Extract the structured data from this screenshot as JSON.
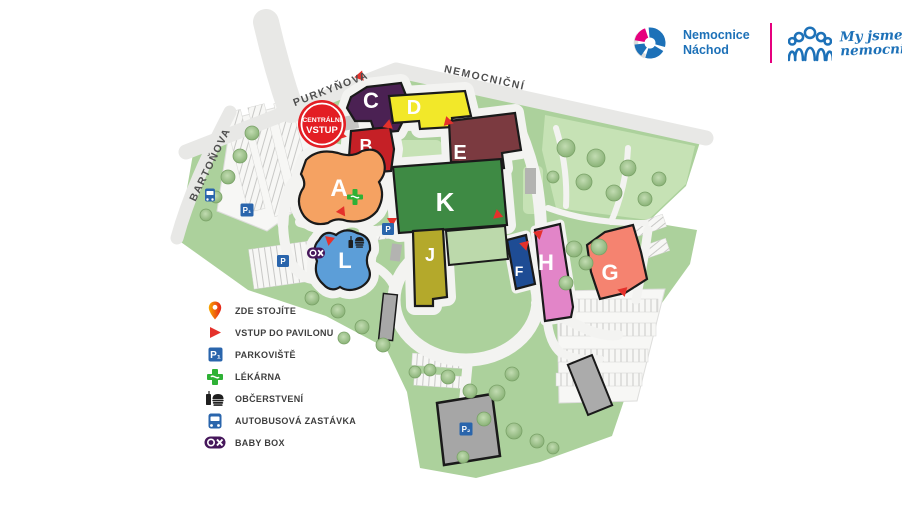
{
  "brand": {
    "hospital_name": [
      "Nemocnice",
      "Náchod"
    ],
    "slogan": [
      "My jsme",
      "nemocnice"
    ]
  },
  "streets": {
    "purkynova": "PURKYŇOVA",
    "nemocnicni": "NEMOCNIČNÍ",
    "bartonova": "BARTOŇOVA"
  },
  "central_entrance": {
    "line1": "CENTRÁLNÍ",
    "line2": "VSTUP"
  },
  "buildings": [
    {
      "label": "A",
      "color": "#F5A262"
    },
    {
      "label": "B",
      "color": "#C52026"
    },
    {
      "label": "C",
      "color": "#4B2153"
    },
    {
      "label": "D",
      "color": "#F2E829"
    },
    {
      "label": "E",
      "color": "#7B3A40"
    },
    {
      "label": "F",
      "color": "#1E4C94"
    },
    {
      "label": "G",
      "color": "#F58370"
    },
    {
      "label": "H",
      "color": "#E285C8"
    },
    {
      "label": "J",
      "color": "#B4A92B"
    },
    {
      "label": "K",
      "color": "#3E8A44"
    },
    {
      "label": "L",
      "color": "#5C9ED8"
    }
  ],
  "parking": {
    "p": "P",
    "p1": "P₁",
    "p2": "P₂"
  },
  "legend": {
    "items": [
      {
        "icon": "you-are-here-pin",
        "label": "ZDE STOJÍTE"
      },
      {
        "icon": "pavilion-entrance-triangle",
        "label": "VSTUP DO PAVILONU"
      },
      {
        "icon": "parking-sign",
        "label": "PARKOVIŠTĚ"
      },
      {
        "icon": "pharmacy-cross",
        "label": "LÉKÁRNA"
      },
      {
        "icon": "refreshment",
        "label": "OBČERSTVENÍ"
      },
      {
        "icon": "bus-stop",
        "label": "AUTOBUSOVÁ ZASTÁVKA"
      },
      {
        "icon": "baby-box",
        "label": "BABY BOX"
      }
    ]
  },
  "accents": {
    "entrance-red": "#E5312B",
    "badge-red": "#E31E24",
    "parking-blue": "#2A65AC",
    "pharmacy-green": "#2EB135",
    "babybox-purple": "#46175B",
    "brand-blue": "#1D71B8",
    "brand-pink": "#E6007E",
    "building-outline": "#1A1A1A",
    "map-green": "#ACD19C",
    "map-green-light": "#C6E2B5",
    "k-wing-green": "#BCD9AB",
    "road-gray": "#E8E8E6",
    "path-gray": "#F3F3F1"
  }
}
